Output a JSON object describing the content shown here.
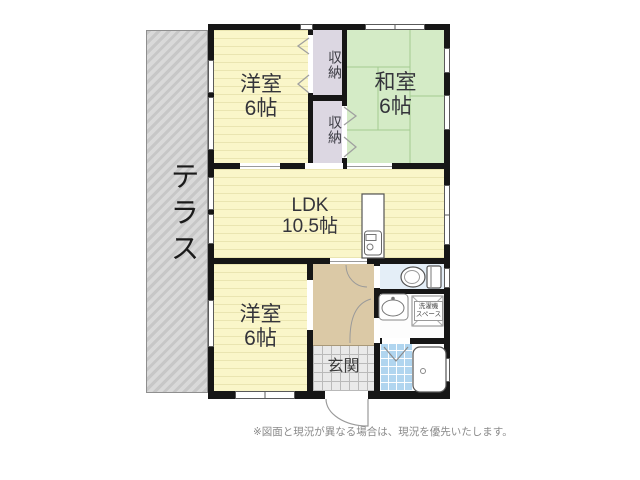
{
  "rooms": {
    "terrace": {
      "label": "テラス"
    },
    "western_room_top": {
      "name": "洋室",
      "size": "6帖"
    },
    "closet_upper": {
      "label": "収納"
    },
    "closet_lower": {
      "label": "収納"
    },
    "japanese_room": {
      "name": "和室",
      "size": "6帖"
    },
    "ldk": {
      "name": "LDK",
      "size": "10.5帖"
    },
    "western_room_bottom": {
      "name": "洋室",
      "size": "6帖"
    },
    "entrance": {
      "label": "玄関"
    },
    "laundry_space": {
      "line1": "洗濯機",
      "line2": "スペース"
    }
  },
  "notes": {
    "disclaimer": "※図面と現況が異なる場合は、現況を優先いたします。"
  },
  "icons": {
    "toilet": "toilet-top-view",
    "washbasin": "oval-sink",
    "bathtub": "bathtub-top-view",
    "kitchen_sink": "kitchen-counter-with-sink",
    "entrance_door": "swing-door-arc",
    "interior_doors": "swing-door-arc",
    "sliding_doors": "chevron-marker",
    "bath_door": "v-fold-door-marker"
  },
  "colors": {
    "wall": "#161616",
    "western_room": "#faf6c9",
    "japanese_room": "#d4ebc6",
    "closet": "#dcd7e2",
    "hall": "#dbc9a6",
    "entrance_tile": "#e9e9e9",
    "toilet_floor": "#e4eef7",
    "bath_tile": "#b0d5ef",
    "terrace": "#d2d2d2"
  }
}
